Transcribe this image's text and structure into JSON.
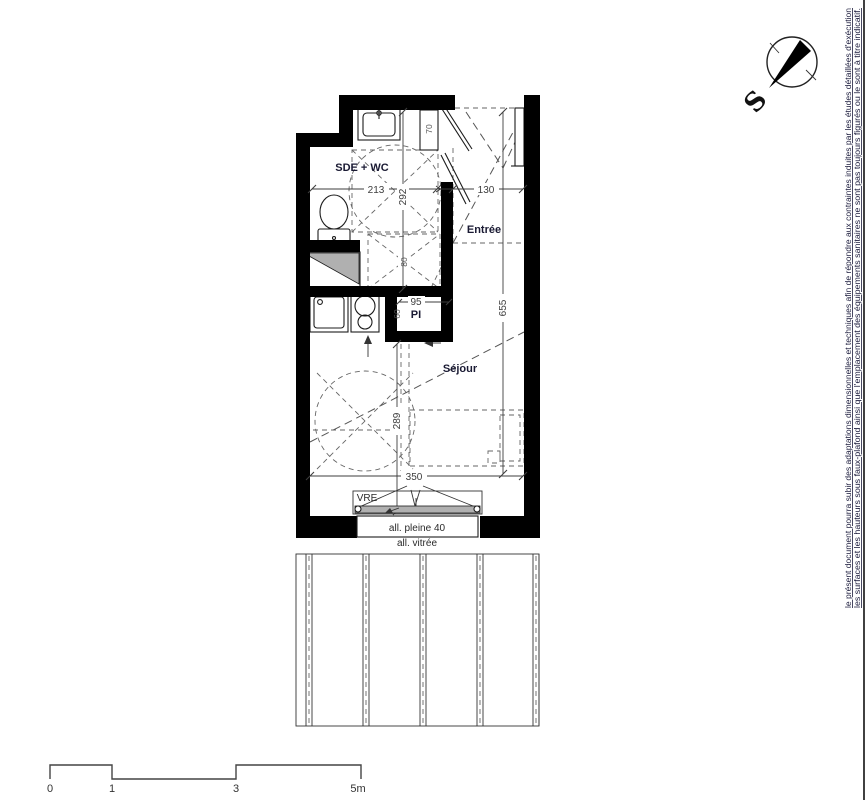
{
  "drawing": {
    "rooms": {
      "bathroom": "SDE + WC",
      "entrance": "Entrée",
      "living": "Séjour",
      "closet": "PI"
    },
    "dimensions": {
      "d213": "213",
      "d292": "292",
      "d130": "130",
      "d70": "70",
      "d80": "80",
      "d95": "95",
      "d60": "60",
      "d655": "655",
      "d289": "289",
      "d350": "350"
    },
    "window": {
      "vre": "VRE",
      "sill_solid": "all. pleine 40",
      "sill_glazed": "all. vitrée"
    },
    "compass": {
      "south": "S"
    },
    "scale_bar": {
      "t0": "0",
      "t1": "1",
      "t3": "3",
      "t5": "5m"
    },
    "disclaimer": {
      "line1": "le présent document pourra subir des adaptations dimensionnelles et techniques afin de répondre aux contraintes induites par les études détaillées d'exécution",
      "line2": "les surfaces et les hauteurs sous faux-plafond ainsi que l'emplacement des équipements sanitaires ne sont pas toujours figurés ou le sont à titre indicatif."
    },
    "colors": {
      "wall": "#000000",
      "glazing_gray": "#b0b0b0",
      "label_text": "#1a1a33",
      "dim_text": "#3d3d3d"
    }
  }
}
